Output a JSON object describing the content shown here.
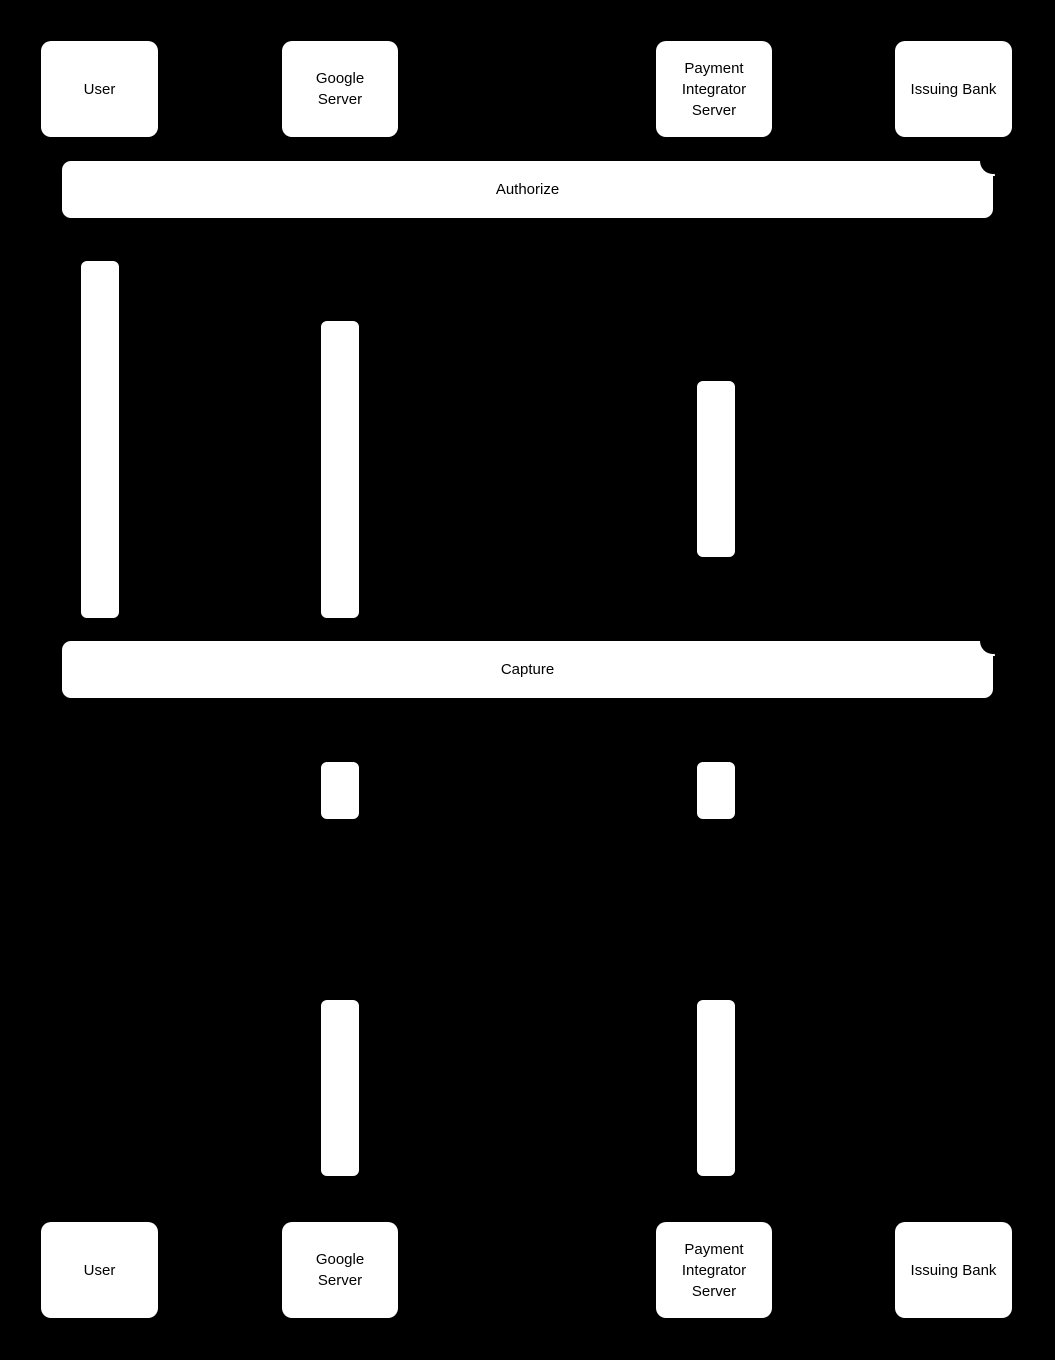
{
  "colors": {
    "background": "#000000",
    "shape_fill": "#ffffff",
    "text": "#000000"
  },
  "actors": [
    {
      "id": "user",
      "name": "User"
    },
    {
      "id": "google-server",
      "name": "Google Server"
    },
    {
      "id": "payment-integrator-server",
      "name": "Payment Integrator Server"
    },
    {
      "id": "issuing-bank",
      "name": "Issuing Bank"
    }
  ],
  "frames": [
    {
      "id": "authorize",
      "label": "Authorize"
    },
    {
      "id": "capture",
      "label": "Capture"
    }
  ]
}
